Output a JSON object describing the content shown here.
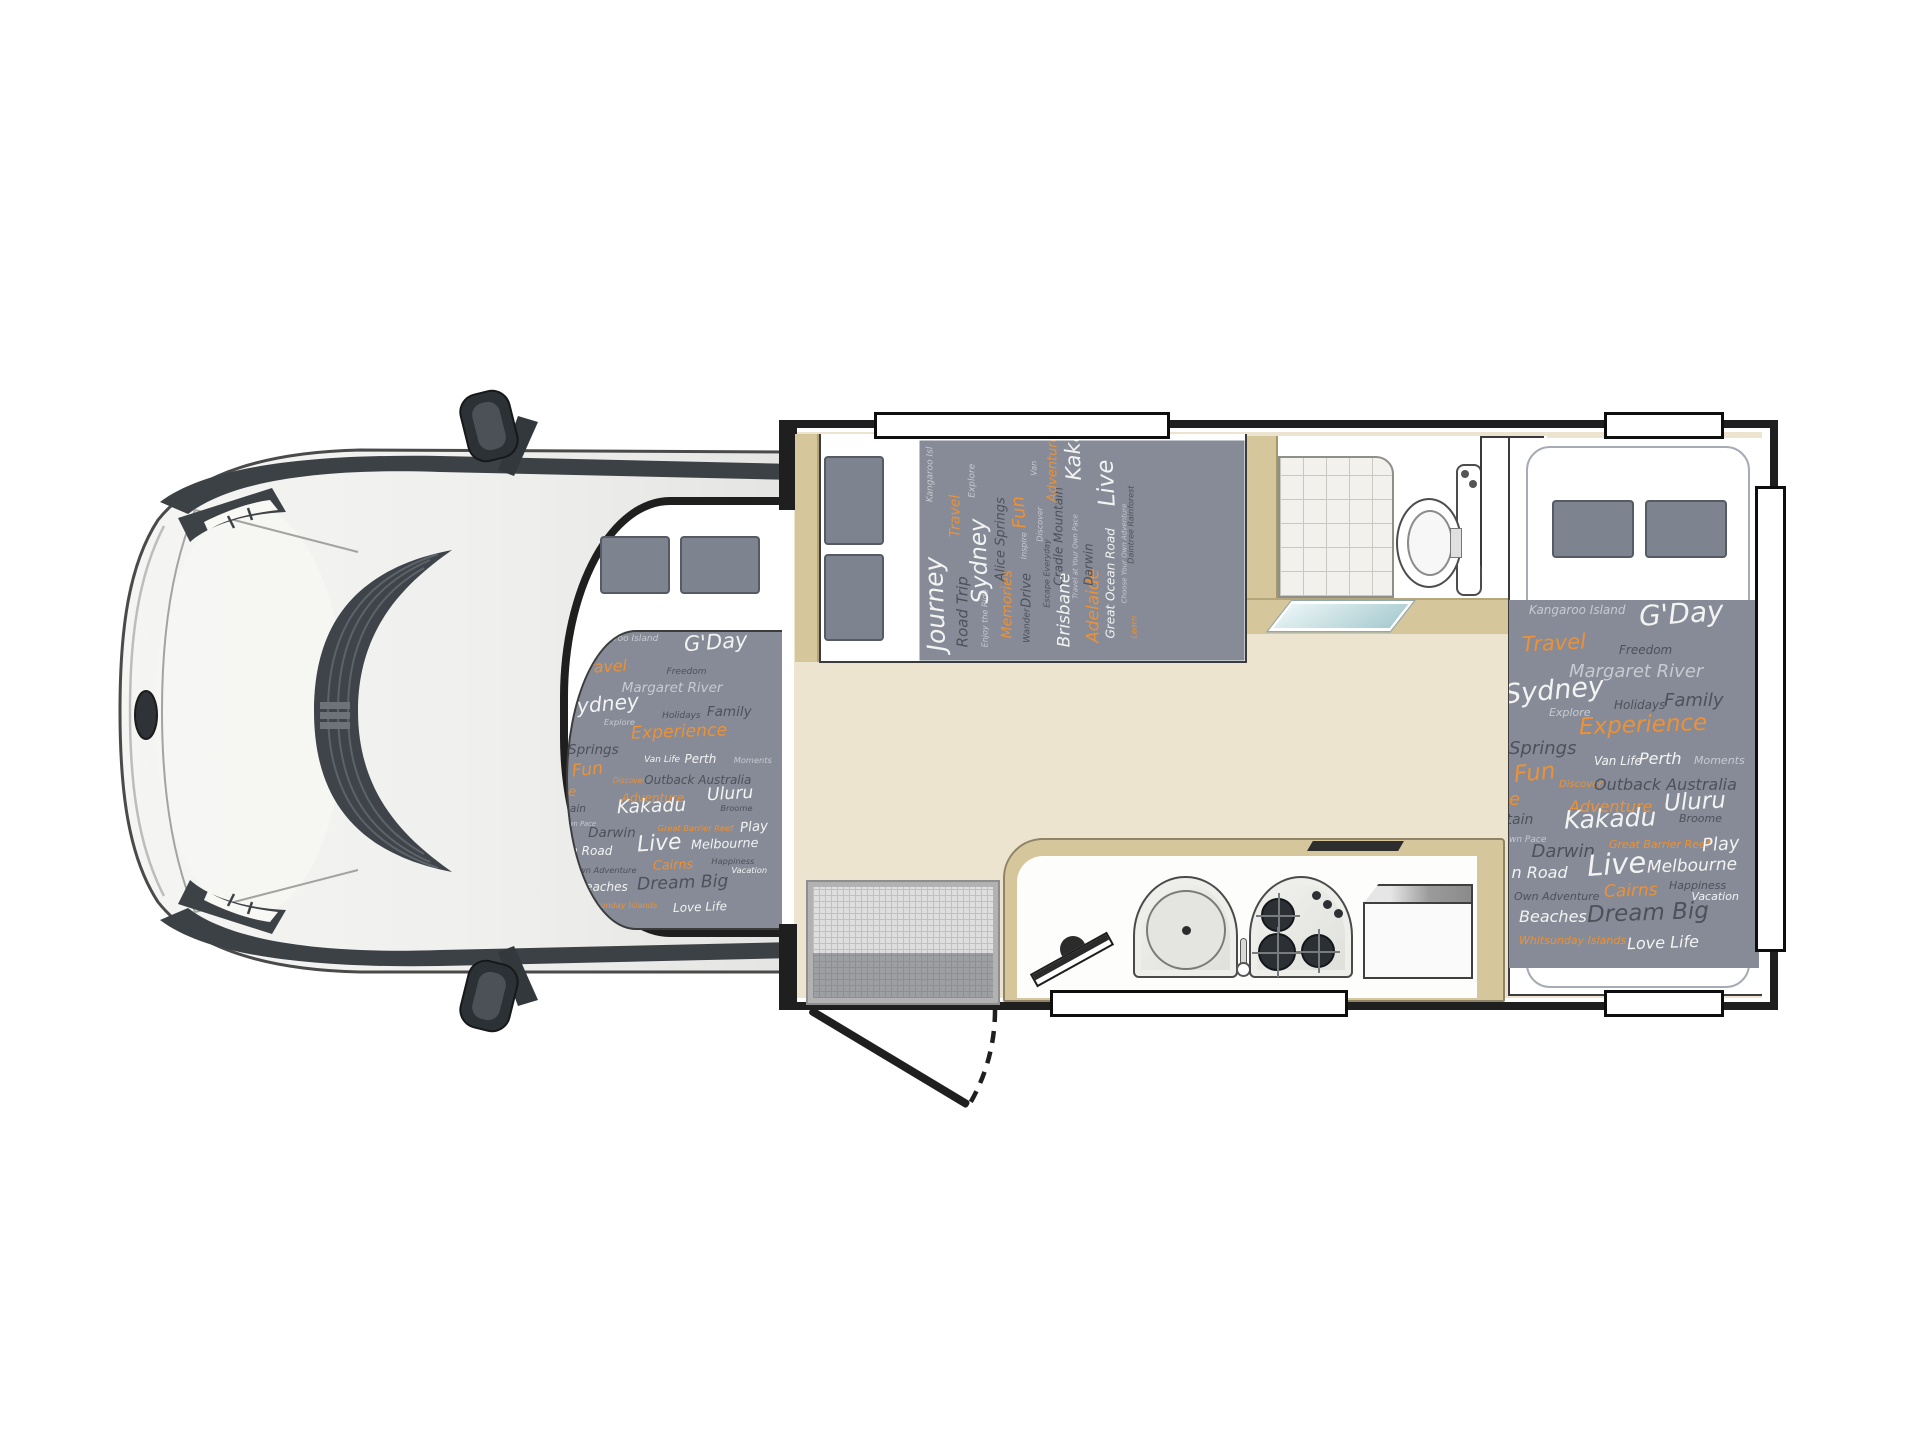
{
  "diagram": {
    "type": "motorhome-floorplan-top-view",
    "areas": [
      "cab",
      "over-cab-bed",
      "front-bed",
      "bathroom",
      "rear-bed",
      "kitchen",
      "entry-door"
    ]
  },
  "colors": {
    "fabric_background": "#868b97",
    "fabric_white": "#f3f3f2",
    "fabric_dark": "#4c515b",
    "fabric_light_grey": "#c7cad1",
    "fabric_orange": "#ec9135",
    "floor_beige": "#ece4cf",
    "wall_tan": "#d5c69c",
    "wall_black": "#1f1f1f",
    "pillow_grey": "#7e8390",
    "shower_tray_teal": "#a9ccd1"
  },
  "fabrics": {
    "rear": {
      "words": [
        {
          "t": "Kangaroo Island",
          "c": "lg",
          "s": 12,
          "x": 8,
          "y": 1
        },
        {
          "t": "G'Day",
          "c": "w",
          "s": 28,
          "x": 52,
          "y": 0,
          "r": -4
        },
        {
          "t": "Travel",
          "c": "o",
          "s": 21,
          "x": 5,
          "y": 9,
          "r": -3
        },
        {
          "t": "Freedom",
          "c": "d",
          "s": 12,
          "x": 44,
          "y": 12
        },
        {
          "t": "Margaret River",
          "c": "lg",
          "s": 18,
          "x": 24,
          "y": 17
        },
        {
          "t": "Sydney",
          "c": "w",
          "s": 27,
          "x": -2,
          "y": 21,
          "r": -5
        },
        {
          "t": "Explore",
          "c": "lg",
          "s": 11,
          "x": 16,
          "y": 29
        },
        {
          "t": "Holidays",
          "c": "d",
          "s": 12,
          "x": 42,
          "y": 27
        },
        {
          "t": "Family",
          "c": "d",
          "s": 18,
          "x": 62,
          "y": 25
        },
        {
          "t": "Experience",
          "c": "o",
          "s": 23,
          "x": 28,
          "y": 31,
          "r": -2
        },
        {
          "t": "Springs",
          "c": "d",
          "s": 18,
          "x": 0,
          "y": 38
        },
        {
          "t": "Fun",
          "c": "o",
          "s": 23,
          "x": 2,
          "y": 44,
          "r": -6
        },
        {
          "t": "Van Life",
          "c": "w",
          "s": 12,
          "x": 34,
          "y": 42
        },
        {
          "t": "Perth",
          "c": "w",
          "s": 16,
          "x": 52,
          "y": 41
        },
        {
          "t": "Moments",
          "c": "lg",
          "s": 11,
          "x": 74,
          "y": 42
        },
        {
          "t": "Discover",
          "c": "o",
          "s": 10,
          "x": 20,
          "y": 49
        },
        {
          "t": "Outback Australia",
          "c": "d",
          "s": 16,
          "x": 34,
          "y": 48
        },
        {
          "t": "e",
          "c": "o",
          "s": 18,
          "x": 0,
          "y": 52
        },
        {
          "t": "Adventure",
          "c": "o",
          "s": 16,
          "x": 24,
          "y": 54
        },
        {
          "t": "Uluru",
          "c": "w",
          "s": 23,
          "x": 62,
          "y": 52,
          "r": -3
        },
        {
          "t": "tain",
          "c": "d",
          "s": 14,
          "x": -1,
          "y": 58
        },
        {
          "t": "Kakadu",
          "c": "w",
          "s": 25,
          "x": 22,
          "y": 56,
          "r": -2
        },
        {
          "t": "Broome",
          "c": "d",
          "s": 11,
          "x": 68,
          "y": 58
        },
        {
          "t": "wn Pace",
          "c": "lg",
          "s": 9,
          "x": 0,
          "y": 64
        },
        {
          "t": "Darwin",
          "c": "d",
          "s": 18,
          "x": 9,
          "y": 66
        },
        {
          "t": "Great Barrier Reef",
          "c": "o",
          "s": 11,
          "x": 40,
          "y": 65
        },
        {
          "t": "Play",
          "c": "w",
          "s": 18,
          "x": 77,
          "y": 64,
          "r": -4
        },
        {
          "t": "n Road",
          "c": "w",
          "s": 16,
          "x": 1,
          "y": 72
        },
        {
          "t": "Live",
          "c": "w",
          "s": 29,
          "x": 31,
          "y": 68,
          "r": -4
        },
        {
          "t": "Melbourne",
          "c": "w",
          "s": 17,
          "x": 55,
          "y": 70,
          "r": -2
        },
        {
          "t": "Happiness",
          "c": "d",
          "s": 11,
          "x": 64,
          "y": 76
        },
        {
          "t": "Own Adventure",
          "c": "d",
          "s": 11,
          "x": 2,
          "y": 79
        },
        {
          "t": "Cairns",
          "c": "o",
          "s": 17,
          "x": 38,
          "y": 77,
          "r": -2
        },
        {
          "t": "Vacation",
          "c": "w",
          "s": 11,
          "x": 73,
          "y": 79
        },
        {
          "t": "Beaches",
          "c": "w",
          "s": 16,
          "x": 4,
          "y": 84
        },
        {
          "t": "Dream Big",
          "c": "d",
          "s": 23,
          "x": 31,
          "y": 82,
          "r": -2
        },
        {
          "t": "Whitsunday Islands",
          "c": "o",
          "s": 11,
          "x": 4,
          "y": 91
        },
        {
          "t": "Love Life",
          "c": "w",
          "s": 16,
          "x": 47,
          "y": 91,
          "r": -2
        }
      ]
    },
    "front": {
      "words": [
        {
          "t": "Journey",
          "c": "w",
          "s": 25,
          "x": 4,
          "y": 1,
          "r": -2
        },
        {
          "t": "Kangaroo Isl",
          "c": "lg",
          "s": 9,
          "x": 72,
          "y": 2
        },
        {
          "t": "Road Trip",
          "c": "d",
          "s": 15,
          "x": 6,
          "y": 11
        },
        {
          "t": "Travel",
          "c": "o",
          "s": 14,
          "x": 56,
          "y": 9
        },
        {
          "t": "Enjoy the Ride",
          "c": "lg",
          "s": 8,
          "x": 6,
          "y": 19
        },
        {
          "t": "Sydney",
          "c": "w",
          "s": 23,
          "x": 26,
          "y": 15,
          "r": -2
        },
        {
          "t": "Explore",
          "c": "lg",
          "s": 9,
          "x": 74,
          "y": 15
        },
        {
          "t": "Memories",
          "c": "o",
          "s": 14,
          "x": 10,
          "y": 25
        },
        {
          "t": "Alice Springs",
          "c": "d",
          "s": 13,
          "x": 36,
          "y": 23
        },
        {
          "t": "Wander",
          "c": "d",
          "s": 9,
          "x": 8,
          "y": 32
        },
        {
          "t": "Drive",
          "c": "d",
          "s": 13,
          "x": 24,
          "y": 31
        },
        {
          "t": "Inspire",
          "c": "lg",
          "s": 8,
          "x": 46,
          "y": 31
        },
        {
          "t": "Fun",
          "c": "o",
          "s": 18,
          "x": 60,
          "y": 28,
          "r": -4
        },
        {
          "t": "Escape Everyday",
          "c": "d",
          "s": 8,
          "x": 24,
          "y": 38
        },
        {
          "t": "Discover",
          "c": "lg",
          "s": 8,
          "x": 54,
          "y": 36
        },
        {
          "t": "Van",
          "c": "lg",
          "s": 8,
          "x": 84,
          "y": 34
        },
        {
          "t": "Brisbane",
          "c": "w",
          "s": 17,
          "x": 6,
          "y": 42
        },
        {
          "t": "Cradle Mountain",
          "c": "d",
          "s": 12,
          "x": 34,
          "y": 41
        },
        {
          "t": "Adventure",
          "c": "o",
          "s": 13,
          "x": 72,
          "y": 39
        },
        {
          "t": "Travel at Your Own Pace",
          "c": "lg",
          "s": 7,
          "x": 28,
          "y": 47
        },
        {
          "t": "Kakadu",
          "c": "w",
          "s": 21,
          "x": 82,
          "y": 44,
          "r": -2
        },
        {
          "t": "Adelaide",
          "c": "o",
          "s": 17,
          "x": 8,
          "y": 51
        },
        {
          "t": "Darwin",
          "c": "d",
          "s": 12,
          "x": 34,
          "y": 50
        },
        {
          "t": "Great Ocean Road",
          "c": "w",
          "s": 12,
          "x": 10,
          "y": 57
        },
        {
          "t": "Live",
          "c": "w",
          "s": 23,
          "x": 70,
          "y": 54,
          "r": -3
        },
        {
          "t": "Choose Your Own Adventure",
          "c": "lg",
          "s": 7,
          "x": 26,
          "y": 62
        },
        {
          "t": "Learn",
          "c": "o",
          "s": 8,
          "x": 10,
          "y": 65
        },
        {
          "t": "Daintree Rainforest",
          "c": "d",
          "s": 8,
          "x": 44,
          "y": 64
        }
      ]
    }
  }
}
